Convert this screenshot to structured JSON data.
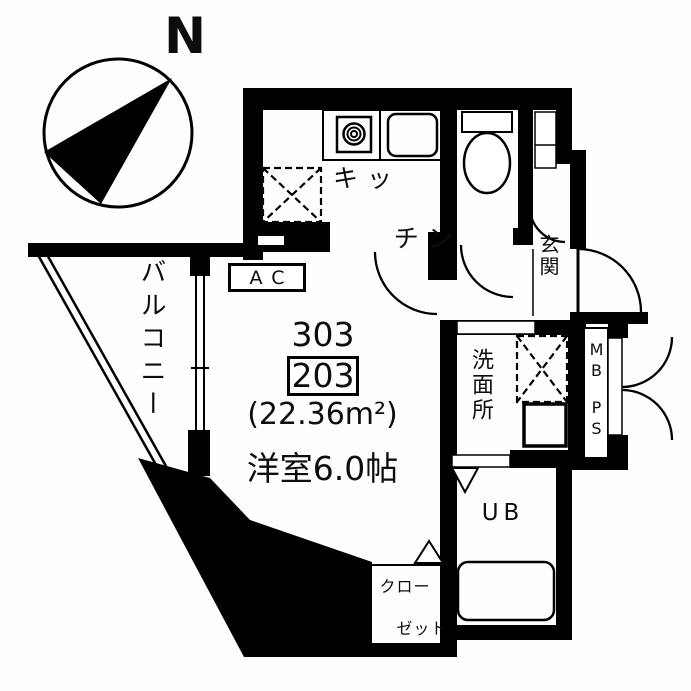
{
  "compass": {
    "north_label": "N"
  },
  "unit": {
    "number_upper": "303",
    "number_boxed": "203",
    "area": "(22.36m²)",
    "main_room_label": "洋室6.0帖"
  },
  "rooms": {
    "kitchen_line1": "キッ",
    "kitchen_line2": "チン",
    "entrance": "玄関",
    "balcony": "バルコニー",
    "washroom": "洗面所",
    "unit_bath": "UB",
    "closet_line1": "クロー",
    "closet_line2": "ゼット",
    "air_conditioner": "AC",
    "meter_box": "MB",
    "pipe_space": "PS"
  },
  "colors": {
    "wall": "#000000",
    "line": "#000000",
    "background": "#ffffff"
  }
}
